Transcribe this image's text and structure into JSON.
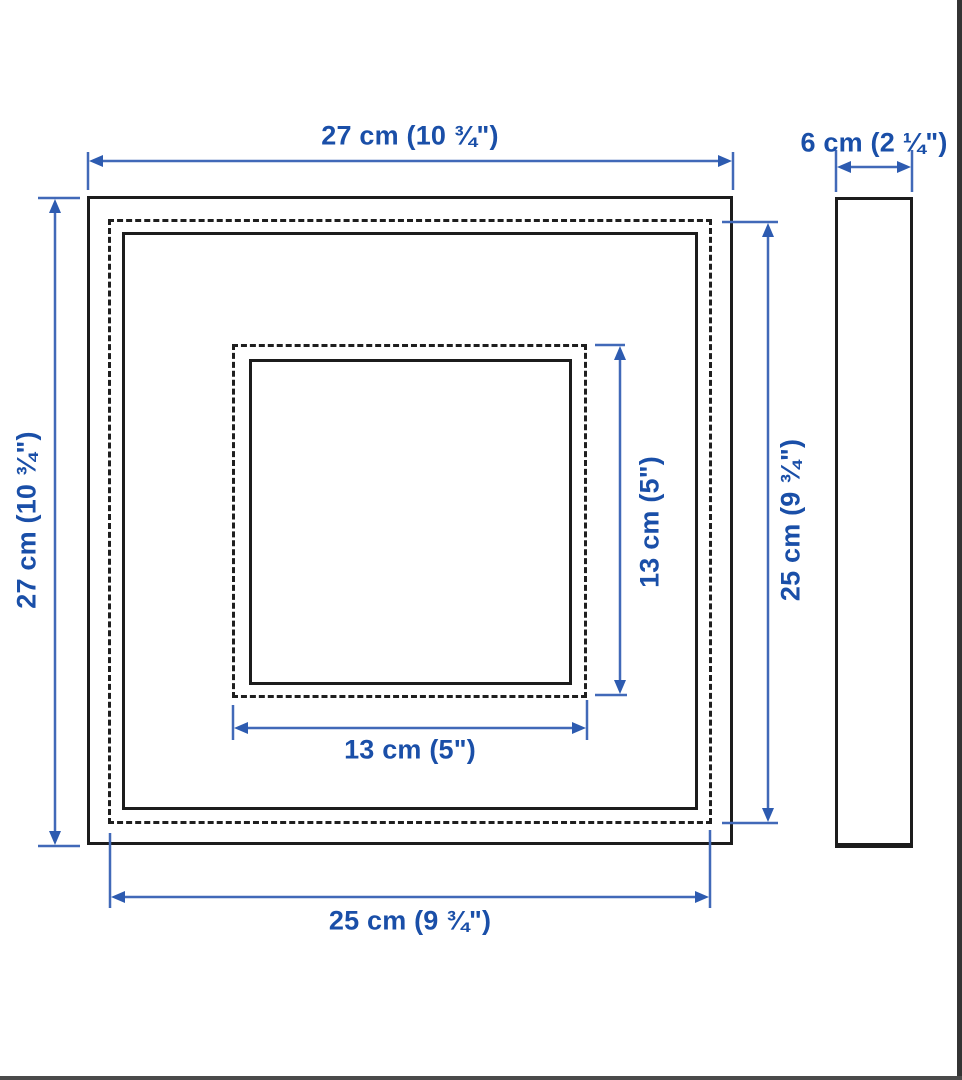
{
  "diagram": {
    "title": "frame-dimension-diagram",
    "views": [
      "front-view",
      "side-view"
    ],
    "colors": {
      "background": "#ffffff",
      "outline": "#1c1c1c",
      "dimension_text": "#1a4fa8",
      "dimension_line": "#4169b8",
      "dimension_arrow": "#2d5bb0"
    },
    "labels": {
      "front_outer_width": "27 cm (10 ¾\")",
      "front_outer_height": "27 cm (10 ¾\")",
      "front_glass_height": "25 cm (9 ¾\")",
      "front_glass_width": "25 cm (9 ¾\")",
      "picture_opening_width": "13 cm (5\")",
      "picture_opening_height": "13 cm (5\")",
      "side_depth": "6 cm (2 ¼\")"
    }
  }
}
